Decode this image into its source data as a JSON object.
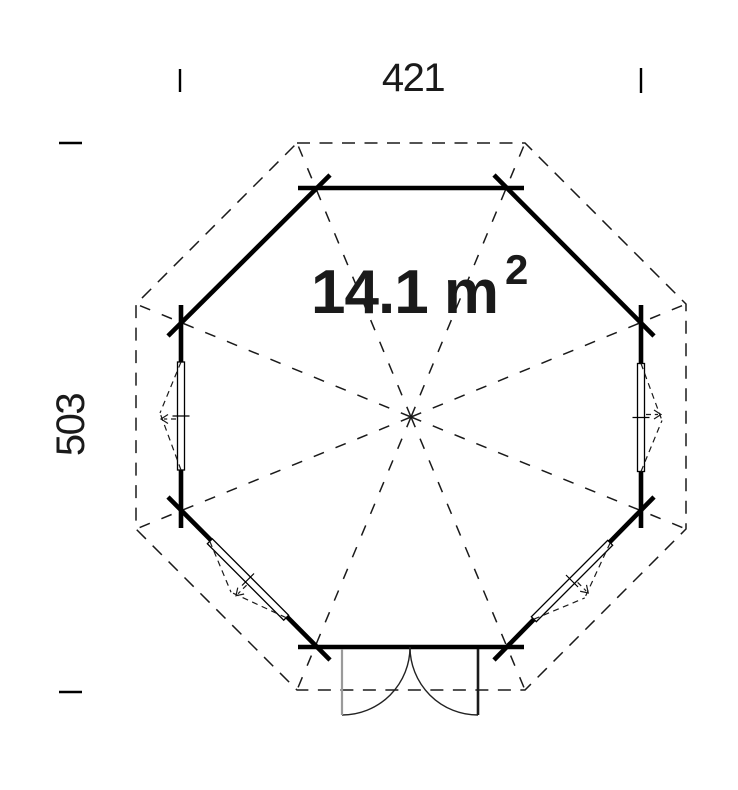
{
  "plan": {
    "title": "octagonal cabin floor plan",
    "shape": "regular octagon, flat side up, double door at bottom",
    "dimensions": {
      "top": "421",
      "left": "503"
    },
    "area": {
      "value": "14.1 m",
      "exponent": "2",
      "full_text": "14.1 m²"
    },
    "features": {
      "door": "double outward-swinging door, bottom wall, centered",
      "windows": [
        "left wall",
        "right wall",
        "lower-left wall",
        "lower-right wall"
      ]
    },
    "colors": {
      "line": "#1a1a1a",
      "wall": "#000000",
      "door_leaf_gray": "#9a9a9a",
      "background": "#ffffff"
    }
  }
}
